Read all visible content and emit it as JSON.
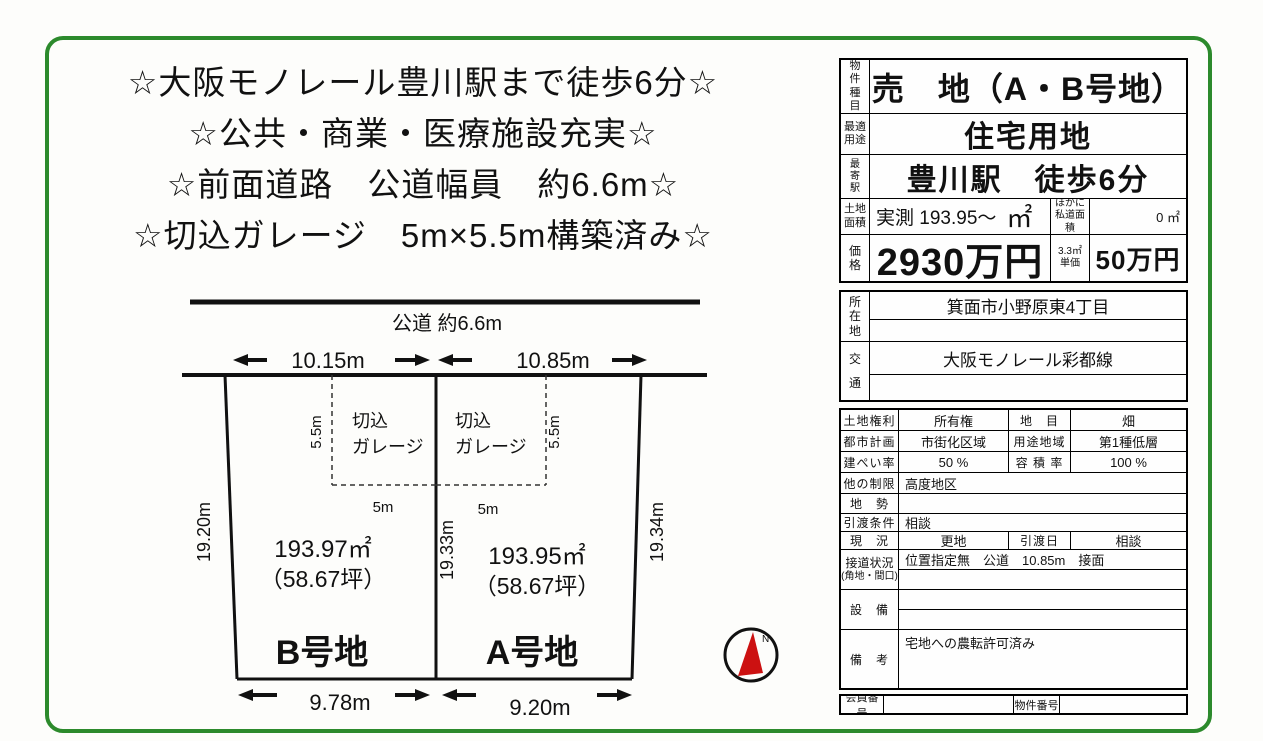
{
  "headline": {
    "lines": [
      "☆大阪モノレール豊川駅まで徒歩6分☆",
      "☆公共・商業・医療施設充実☆",
      "☆前面道路　公道幅員　約6.6m☆",
      "☆切込ガレージ　5m×5.5m構築済み☆"
    ]
  },
  "diagram": {
    "road_label": "公道 約6.6m",
    "b_top_width": "10.15m",
    "a_top_width": "10.85m",
    "garage_line1": "切込",
    "garage_line2": "ガレージ",
    "garage_depth": "5.5m",
    "garage_width": "5m",
    "side_left": "19.20m",
    "side_center": "19.33m",
    "side_right": "19.34m",
    "parcel_b": {
      "area": "193.97㎡",
      "tsubo": "（58.67坪）",
      "name": "B号地",
      "bottom_width": "9.78m"
    },
    "parcel_a": {
      "area": "193.95㎡",
      "tsubo": "（58.67坪）",
      "name": "A号地",
      "bottom_width": "9.20m"
    },
    "compass_n": "N"
  },
  "table": {
    "type_label": "物件種目",
    "type_value": "売　地（A・B号地）",
    "use_label": "最適用途",
    "use_value": "住宅用地",
    "station_label": "最寄駅",
    "station_value": "豊川駅　徒歩6分",
    "area_label": "土地面積",
    "area_value": "実測 193.95～",
    "area_unit": "㎡",
    "private_road_label": "ほかに私道面積",
    "private_road_value": "0 ㎡",
    "price_label": "価格",
    "price_value": "2930万円",
    "unit_price_label": "3.3㎡単価",
    "unit_price_value": "50万円",
    "location_label": "所在地",
    "location_value": "箕面市小野原東4丁目",
    "transport_label": "交通",
    "transport_value": "大阪モノレール彩都線",
    "rights_label": "土地権利",
    "rights_value": "所有権",
    "category_label": "地　目",
    "category_value": "畑",
    "cityplan_label": "都市計画",
    "cityplan_value": "市街化区域",
    "zoning_label": "用途地域",
    "zoning_value": "第1種低層",
    "coverage_label": "建ぺい率",
    "coverage_value": "50 %",
    "floorratio_label": "容 積 率",
    "floorratio_value": "100 %",
    "restrict_label": "他の制限",
    "restrict_value": "高度地区",
    "topo_label": "地　勢",
    "topo_value": "",
    "handover_label": "引渡条件",
    "handover_value": "相談",
    "status_label": "現　況",
    "status_value": "更地",
    "handover_date_label": "引渡日",
    "handover_date_value": "相談",
    "road_contact_label": "接道状況",
    "road_contact_label2": "(角地・間口)",
    "road_contact_value": "位置指定無　公道　10.85m　接面",
    "facilities_label": "設　備",
    "remarks_label": "備　考",
    "remarks_value": "宅地への農転許可済み",
    "member_no_label": "会員番号",
    "property_no_label": "物件番号"
  }
}
